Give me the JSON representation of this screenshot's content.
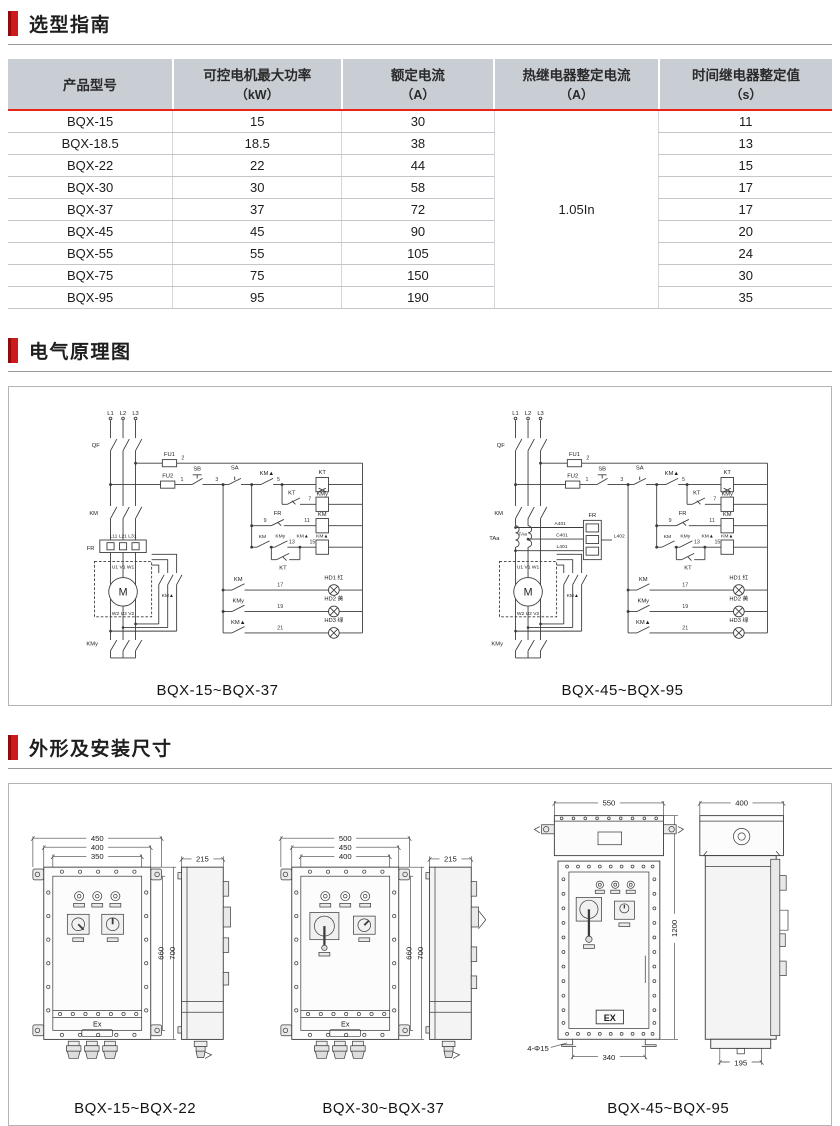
{
  "colors": {
    "accent_red": "#cb1b1b",
    "table_header_bg": "#c9ced5",
    "table_header_rule": "#e8241c"
  },
  "sections": {
    "selection": {
      "title": "选型指南"
    },
    "schematic": {
      "title": "电气原理图"
    },
    "dimensions": {
      "title": "外形及安装尺寸"
    }
  },
  "table": {
    "headers": [
      {
        "line1": "产品型号",
        "line2": ""
      },
      {
        "line1": "可控电机最大功率",
        "line2": "（kW）"
      },
      {
        "line1": "额定电流",
        "line2": "（A）"
      },
      {
        "line1": "热继电器整定电流",
        "line2": "（A）"
      },
      {
        "line1": "时间继电器整定值",
        "line2": "（s）"
      }
    ],
    "thermal_merged": "1.05In",
    "rows": [
      {
        "model": "BQX-15",
        "power": "15",
        "current": "30",
        "time": "11"
      },
      {
        "model": "BQX-18.5",
        "power": "18.5",
        "current": "38",
        "time": "13"
      },
      {
        "model": "BQX-22",
        "power": "22",
        "current": "44",
        "time": "15"
      },
      {
        "model": "BQX-30",
        "power": "30",
        "current": "58",
        "time": "17"
      },
      {
        "model": "BQX-37",
        "power": "37",
        "current": "72",
        "time": "17"
      },
      {
        "model": "BQX-45",
        "power": "45",
        "current": "90",
        "time": "20"
      },
      {
        "model": "BQX-55",
        "power": "55",
        "current": "105",
        "time": "24"
      },
      {
        "model": "BQX-75",
        "power": "75",
        "current": "150",
        "time": "30"
      },
      {
        "model": "BQX-95",
        "power": "95",
        "current": "190",
        "time": "35"
      }
    ]
  },
  "sch1": {
    "caption": "BQX-15~BQX-37",
    "labels": {
      "l1": "L1",
      "l2": "L2",
      "l3": "L3",
      "qf": "QF",
      "fu1": "FU1",
      "n2": "2",
      "fu2": "FU2",
      "n1": "1",
      "sb": "SB",
      "n3": "3",
      "sa": "SA",
      "kmd1": "KM▲",
      "n5": "5",
      "kt_coil": "KT",
      "kt_c": "KT",
      "n7": "7",
      "kmy_coil": "KMy",
      "n9": "9",
      "fr_c": "FR",
      "n11": "11",
      "km_coil": "KM",
      "km_c": "KM",
      "kmy_c": "KMy",
      "n13": "13",
      "kmd2": "KM▲",
      "n15": "15",
      "kmd_coil": "KM▲",
      "kt2": "KT",
      "km_l": "KM",
      "n17": "17",
      "hd1": "HD1 红",
      "kmy_l": "KMy",
      "n19": "19",
      "hd2": "HD2 黄",
      "kmd_l": "KM▲",
      "n21": "21",
      "hd3": "HD3 绿",
      "km_main": "KM",
      "lxx": "L11 L21 L31",
      "fr_box": "FR",
      "uvw": "U1 V1 W1",
      "m": "M",
      "wuv": "W2 U2 V2",
      "kmd_m": "KM▲",
      "kmy_b": "KMy"
    }
  },
  "sch2": {
    "caption": "BQX-45~BQX-95",
    "labels": {
      "l1": "L1",
      "l2": "L2",
      "l3": "L3",
      "qf": "QF",
      "fu1": "FU1",
      "n2": "2",
      "fu2": "FU2",
      "n1": "1",
      "sb": "SB",
      "n3": "3",
      "sa": "SA",
      "kmd1": "KM▲",
      "n5": "5",
      "kt_coil": "KT",
      "kt_c": "KT",
      "n7": "7",
      "kmy_coil": "KMy",
      "n9": "9",
      "fr_c": "FR",
      "n11": "11",
      "km_coil": "KM",
      "km_c": "KM",
      "kmy_c": "KMy",
      "n13": "13",
      "kmd2": "KM▲",
      "n15": "15",
      "kmd_coil": "KM▲",
      "kt2": "KT",
      "km_l": "KM",
      "n17": "17",
      "hd1": "HD1 红",
      "kmy_l": "KMy",
      "n19": "19",
      "hd2": "HD2 黄",
      "kmd_l": "KM▲",
      "n21": "21",
      "hd3": "HD3 绿",
      "km_main": "KM",
      "taa": "TAa",
      "taa2": "TAa",
      "a401": "A401",
      "c401": "C401",
      "l401": "L401",
      "l402": "L402",
      "fr_box": "FR",
      "uvw": "U1 V1 W1",
      "m": "M",
      "wuv": "W2 U2 V2",
      "kmd_m": "KM▲",
      "kmy_b": "KMy"
    }
  },
  "d1": {
    "caption": "BQX-15~BQX-22",
    "w450": "450",
    "w400": "400",
    "w350": "350",
    "h700": "700",
    "h660": "660",
    "side215": "215",
    "ex": "Ex"
  },
  "d2": {
    "caption": "BQX-30~BQX-37",
    "w500": "500",
    "w450": "450",
    "w400": "400",
    "h700": "700",
    "h660": "660",
    "side215": "215",
    "ex": "Ex"
  },
  "d3": {
    "caption": "BQX-45~BQX-95",
    "w550": "550",
    "w400": "400",
    "h1200": "1200",
    "b340": "340",
    "b195": "195",
    "holes": "4-Φ15",
    "ex": "EX"
  }
}
